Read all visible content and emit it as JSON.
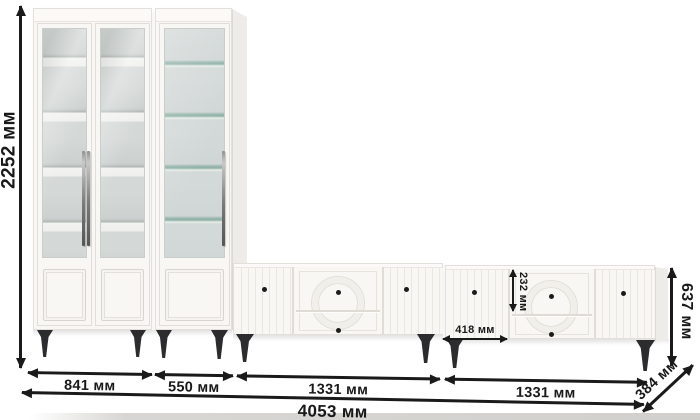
{
  "diagram": {
    "unit": "мм",
    "labels": {
      "total_height": "2252 мм",
      "bookcase_width": "841 мм",
      "display_cabinet_width": "550 мм",
      "tv_stand_left_width": "1331 мм",
      "tv_stand_right_width": "1331 мм",
      "total_width": "4053 мм",
      "tv_stand_height": "637 мм",
      "tv_stand_depth": "384 мм",
      "tv_left_door_width": "418 мм",
      "tv_top_drawer_height": "232 мм"
    },
    "colors": {
      "background": "#ffffff",
      "furniture_white": "#f8f7f4",
      "dimension_line": "#1a1a1a",
      "legs": "#2c2b2d",
      "glass_back": "#d3d9d8",
      "glass_shelf_tint": "#9cbab1"
    }
  }
}
